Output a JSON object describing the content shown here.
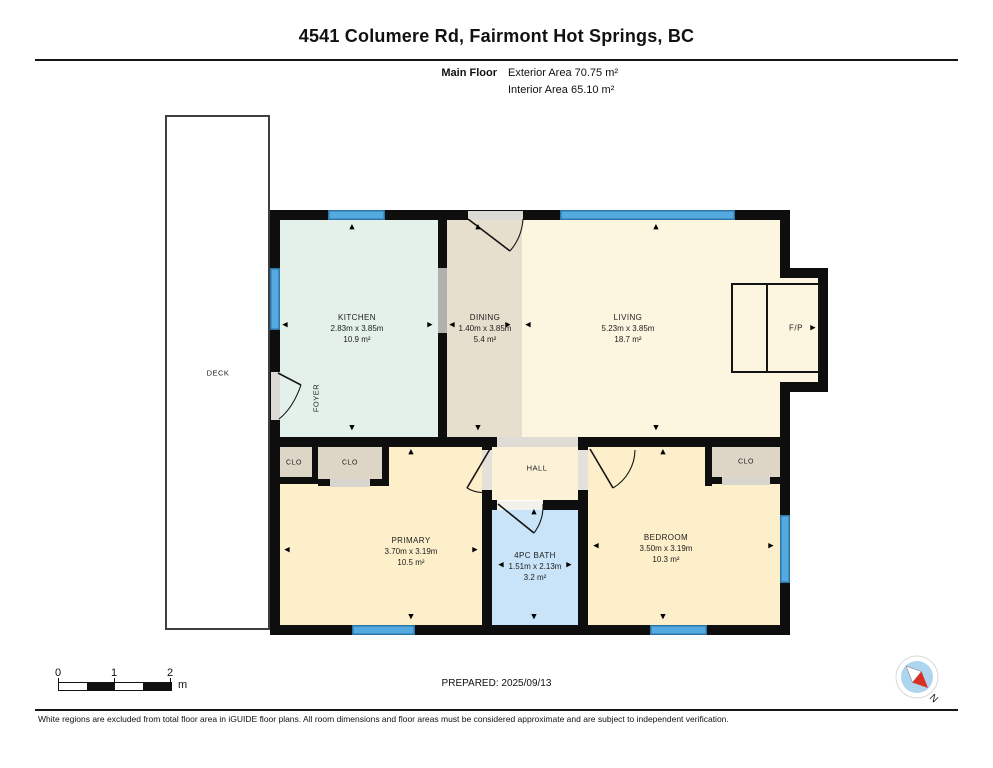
{
  "header": {
    "title": "4541 Columere Rd, Fairmont Hot Springs, BC",
    "floor_label": "Main Floor",
    "exterior_area": "Exterior Area 70.75 m²",
    "interior_area": "Interior Area 65.10 m²"
  },
  "rooms": {
    "kitchen": {
      "name": "KITCHEN",
      "dims": "2.83m x 3.85m",
      "area": "10.9 m²"
    },
    "dining": {
      "name": "DINING",
      "dims": "1.40m x 3.85m",
      "area": "5.4 m²"
    },
    "living": {
      "name": "LIVING",
      "dims": "5.23m x 3.85m",
      "area": "18.7 m²"
    },
    "primary": {
      "name": "PRIMARY",
      "dims": "3.70m x 3.19m",
      "area": "10.5 m²"
    },
    "bath": {
      "name": "4PC BATH",
      "dims": "1.51m x 2.13m",
      "area": "3.2 m²"
    },
    "bedroom": {
      "name": "BEDROOM",
      "dims": "3.50m x 3.19m",
      "area": "10.3 m²"
    }
  },
  "labels": {
    "deck": "DECK",
    "foyer": "FOYER",
    "hall": "HALL",
    "fireplace": "F/P",
    "closet": "CLO"
  },
  "icons": {
    "arrow_up": "▲",
    "arrow_down": "▼",
    "arrow_left": "◀",
    "arrow_right": "▶",
    "compass_icon": "N"
  },
  "scalebar": {
    "t0": "0",
    "t1": "1",
    "t2": "2",
    "unit": "m"
  },
  "prepared": "PREPARED: 2025/09/13",
  "disclaimer": "White regions are excluded from total floor area in iGUIDE floor plans. All room dimensions and floor areas must be considered approximate and are subject to independent verification.",
  "compass": {
    "north_label": "N"
  },
  "colors": {
    "wall": "#0e0e0e",
    "window_blue": "#55abdf",
    "kitchen": "#e4f1ea",
    "dining": "#e6dfcd",
    "living": "#fcf5e0",
    "bedroom": "#fcefca",
    "bath": "#c9e4f8",
    "closet": "#ddd6c7",
    "compass_red": "#d93025",
    "compass_blue": "#aed5ef"
  }
}
